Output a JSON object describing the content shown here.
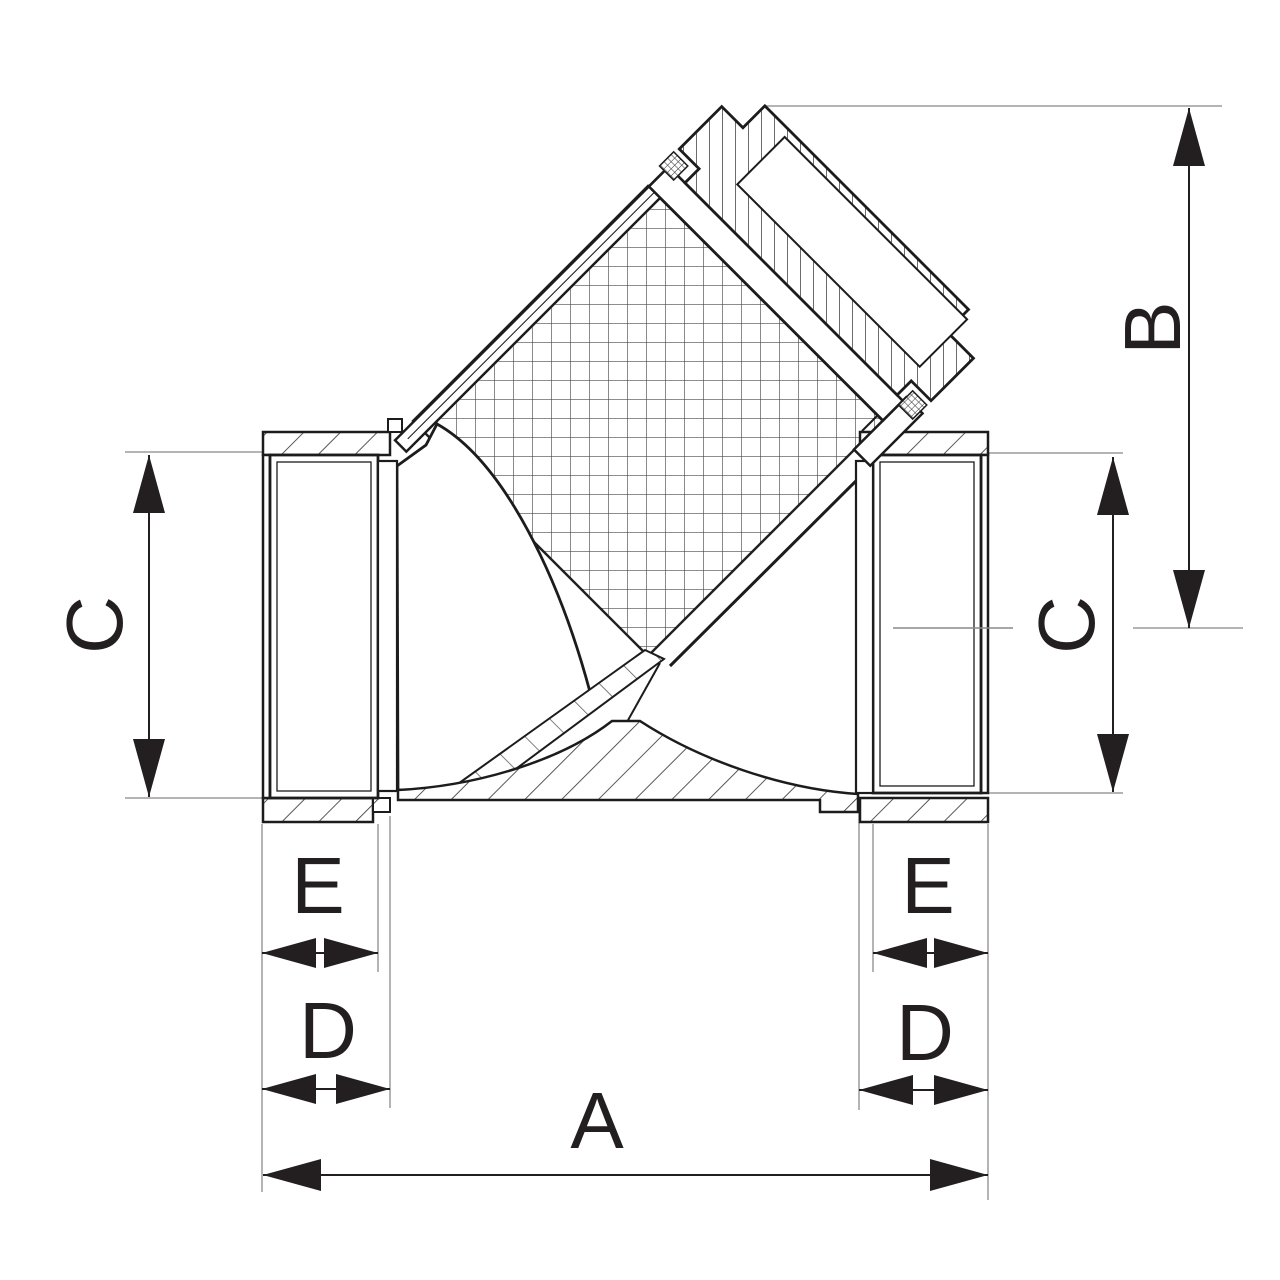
{
  "figure": {
    "kind": "engineering-section-drawing",
    "subject": "y-strainer-valve-cross-section",
    "background": "#ffffff"
  },
  "colors": {
    "ink": "#231f20",
    "outline": "#1c1c1c",
    "hatch": "#3a3a3a",
    "mesh_grid": "#4a4a4a",
    "extension_line": "#9b9b9b",
    "centerline": "#8a8a8a"
  },
  "dimensions": {
    "a": {
      "label": "A",
      "orientation": "horizontal",
      "role": "overall-face-to-face-length"
    },
    "b": {
      "label": "B",
      "orientation": "vertical",
      "role": "centerline-to-cap-top-height"
    },
    "c_left": {
      "label": "C",
      "orientation": "vertical",
      "role": "left-port-bore"
    },
    "c_right": {
      "label": "C",
      "orientation": "vertical",
      "role": "right-port-bore"
    },
    "d_left": {
      "label": "D",
      "orientation": "horizontal",
      "role": "left-socket-depth"
    },
    "d_right": {
      "label": "D",
      "orientation": "horizontal",
      "role": "right-socket-depth"
    },
    "e_left": {
      "label": "E",
      "orientation": "horizontal",
      "role": "left-thread-length"
    },
    "e_right": {
      "label": "E",
      "orientation": "horizontal",
      "role": "right-thread-length"
    }
  }
}
